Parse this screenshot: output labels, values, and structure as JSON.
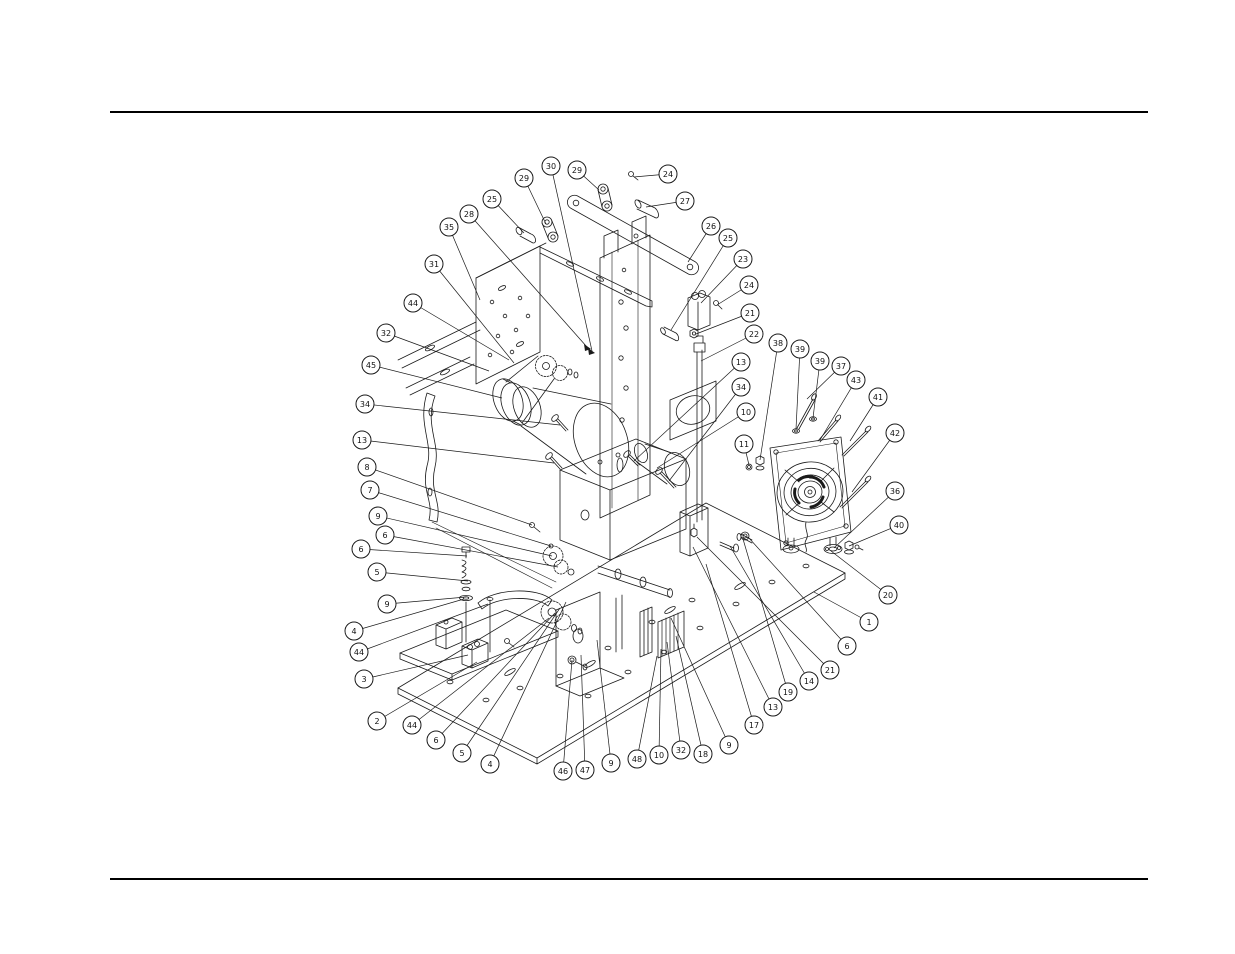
{
  "page": {
    "width": 1235,
    "height": 954,
    "background": "#ffffff",
    "rules": {
      "color": "#000000",
      "thickness": 2,
      "x1": 110,
      "x2": 1148,
      "top_y": 112,
      "bottom_y": 879
    }
  },
  "diagram": {
    "kind": "exploded-parts-diagram",
    "line_color": "#1a1a1a",
    "balloon_style": {
      "radius": 9,
      "fill": "#ffffff",
      "stroke": "#1a1a1a",
      "font_size": 8
    },
    "callout_numbers": [
      1,
      2,
      3,
      4,
      5,
      6,
      7,
      8,
      9,
      10,
      11,
      13,
      14,
      17,
      18,
      19,
      20,
      21,
      22,
      23,
      24,
      25,
      26,
      27,
      28,
      29,
      30,
      31,
      32,
      34,
      35,
      36,
      37,
      38,
      39,
      40,
      41,
      42,
      43,
      44,
      45,
      46,
      47,
      48
    ],
    "balloons": [
      {
        "n": "30",
        "x": 551,
        "y": 166,
        "tx": 592,
        "ty": 351
      },
      {
        "n": "29",
        "x": 577,
        "y": 170,
        "tx": 599,
        "ty": 190
      },
      {
        "n": "24",
        "x": 668,
        "y": 174,
        "tx": 634,
        "ty": 177
      },
      {
        "n": "29",
        "x": 524,
        "y": 178,
        "tx": 546,
        "ty": 224
      },
      {
        "n": "25",
        "x": 492,
        "y": 199,
        "tx": 524,
        "ty": 233
      },
      {
        "n": "27",
        "x": 685,
        "y": 201,
        "tx": 646,
        "ty": 207
      },
      {
        "n": "28",
        "x": 469,
        "y": 214,
        "tx": 587,
        "ty": 347
      },
      {
        "n": "26",
        "x": 711,
        "y": 226,
        "tx": 688,
        "ty": 262
      },
      {
        "n": "35",
        "x": 449,
        "y": 227,
        "tx": 480,
        "ty": 300
      },
      {
        "n": "25",
        "x": 728,
        "y": 238,
        "tx": 671,
        "ty": 330
      },
      {
        "n": "23",
        "x": 743,
        "y": 259,
        "tx": 701,
        "ty": 303
      },
      {
        "n": "31",
        "x": 434,
        "y": 264,
        "tx": 514,
        "ty": 363
      },
      {
        "n": "24",
        "x": 749,
        "y": 285,
        "tx": 717,
        "ty": 305
      },
      {
        "n": "44",
        "x": 413,
        "y": 303,
        "tx": 509,
        "ty": 360
      },
      {
        "n": "21",
        "x": 750,
        "y": 313,
        "tx": 696,
        "ty": 334
      },
      {
        "n": "32",
        "x": 386,
        "y": 333,
        "tx": 489,
        "ty": 371
      },
      {
        "n": "22",
        "x": 754,
        "y": 334,
        "tx": 701,
        "ty": 361
      },
      {
        "n": "38",
        "x": 778,
        "y": 343,
        "tx": 760,
        "ty": 460
      },
      {
        "n": "39",
        "x": 800,
        "y": 349,
        "tx": 796,
        "ty": 429
      },
      {
        "n": "39",
        "x": 820,
        "y": 361,
        "tx": 813,
        "ty": 418
      },
      {
        "n": "13",
        "x": 741,
        "y": 362,
        "tx": 634,
        "ty": 461
      },
      {
        "n": "37",
        "x": 841,
        "y": 366,
        "tx": 807,
        "ty": 399
      },
      {
        "n": "45",
        "x": 371,
        "y": 365,
        "tx": 502,
        "ty": 398
      },
      {
        "n": "43",
        "x": 856,
        "y": 380,
        "tx": 820,
        "ty": 440
      },
      {
        "n": "34",
        "x": 741,
        "y": 387,
        "tx": 669,
        "ty": 481
      },
      {
        "n": "41",
        "x": 878,
        "y": 397,
        "tx": 850,
        "ty": 441
      },
      {
        "n": "34",
        "x": 365,
        "y": 404,
        "tx": 560,
        "ty": 425
      },
      {
        "n": "10",
        "x": 746,
        "y": 412,
        "tx": 657,
        "ty": 468
      },
      {
        "n": "42",
        "x": 895,
        "y": 433,
        "tx": 852,
        "ty": 492
      },
      {
        "n": "13",
        "x": 362,
        "y": 440,
        "tx": 554,
        "ty": 463
      },
      {
        "n": "11",
        "x": 744,
        "y": 444,
        "tx": 749,
        "ty": 465
      },
      {
        "n": "8",
        "x": 367,
        "y": 467,
        "tx": 532,
        "ty": 525
      },
      {
        "n": "36",
        "x": 895,
        "y": 491,
        "tx": 834,
        "ty": 548
      },
      {
        "n": "7",
        "x": 370,
        "y": 490,
        "tx": 551,
        "ty": 546
      },
      {
        "n": "9",
        "x": 378,
        "y": 516,
        "tx": 552,
        "ty": 556
      },
      {
        "n": "40",
        "x": 899,
        "y": 525,
        "tx": 849,
        "ty": 546
      },
      {
        "n": "6",
        "x": 385,
        "y": 535,
        "tx": 558,
        "ty": 567
      },
      {
        "n": "6",
        "x": 361,
        "y": 549,
        "tx": 467,
        "ty": 556
      },
      {
        "n": "5",
        "x": 377,
        "y": 572,
        "tx": 468,
        "ty": 581
      },
      {
        "n": "20",
        "x": 888,
        "y": 595,
        "tx": 831,
        "ty": 551
      },
      {
        "n": "9",
        "x": 387,
        "y": 604,
        "tx": 466,
        "ty": 597
      },
      {
        "n": "1",
        "x": 869,
        "y": 622,
        "tx": 814,
        "ty": 592
      },
      {
        "n": "4",
        "x": 354,
        "y": 631,
        "tx": 464,
        "ty": 599
      },
      {
        "n": "6",
        "x": 847,
        "y": 646,
        "tx": 748,
        "ty": 537
      },
      {
        "n": "44",
        "x": 359,
        "y": 652,
        "tx": 488,
        "ty": 604
      },
      {
        "n": "21",
        "x": 830,
        "y": 670,
        "tx": 697,
        "ty": 537
      },
      {
        "n": "3",
        "x": 364,
        "y": 679,
        "tx": 468,
        "ty": 655
      },
      {
        "n": "14",
        "x": 809,
        "y": 681,
        "tx": 730,
        "ty": 546
      },
      {
        "n": "19",
        "x": 788,
        "y": 692,
        "tx": 743,
        "ty": 539
      },
      {
        "n": "13",
        "x": 773,
        "y": 707,
        "tx": 693,
        "ty": 547
      },
      {
        "n": "2",
        "x": 377,
        "y": 721,
        "tx": 477,
        "ty": 662
      },
      {
        "n": "44",
        "x": 412,
        "y": 725,
        "tx": 549,
        "ty": 618
      },
      {
        "n": "17",
        "x": 754,
        "y": 725,
        "tx": 706,
        "ty": 564
      },
      {
        "n": "6",
        "x": 436,
        "y": 740,
        "tx": 555,
        "ty": 613
      },
      {
        "n": "9",
        "x": 729,
        "y": 745,
        "tx": 671,
        "ty": 618
      },
      {
        "n": "5",
        "x": 462,
        "y": 753,
        "tx": 560,
        "ty": 608
      },
      {
        "n": "18",
        "x": 703,
        "y": 754,
        "tx": 676,
        "ty": 636
      },
      {
        "n": "32",
        "x": 681,
        "y": 750,
        "tx": 667,
        "ty": 642
      },
      {
        "n": "10",
        "x": 659,
        "y": 755,
        "tx": 661,
        "ty": 649
      },
      {
        "n": "48",
        "x": 637,
        "y": 759,
        "tx": 657,
        "ty": 656
      },
      {
        "n": "4",
        "x": 490,
        "y": 764,
        "tx": 566,
        "ty": 602
      },
      {
        "n": "9",
        "x": 611,
        "y": 763,
        "tx": 597,
        "ty": 640
      },
      {
        "n": "47",
        "x": 585,
        "y": 770,
        "tx": 581,
        "ty": 655
      },
      {
        "n": "46",
        "x": 563,
        "y": 771,
        "tx": 572,
        "ty": 660
      }
    ]
  }
}
